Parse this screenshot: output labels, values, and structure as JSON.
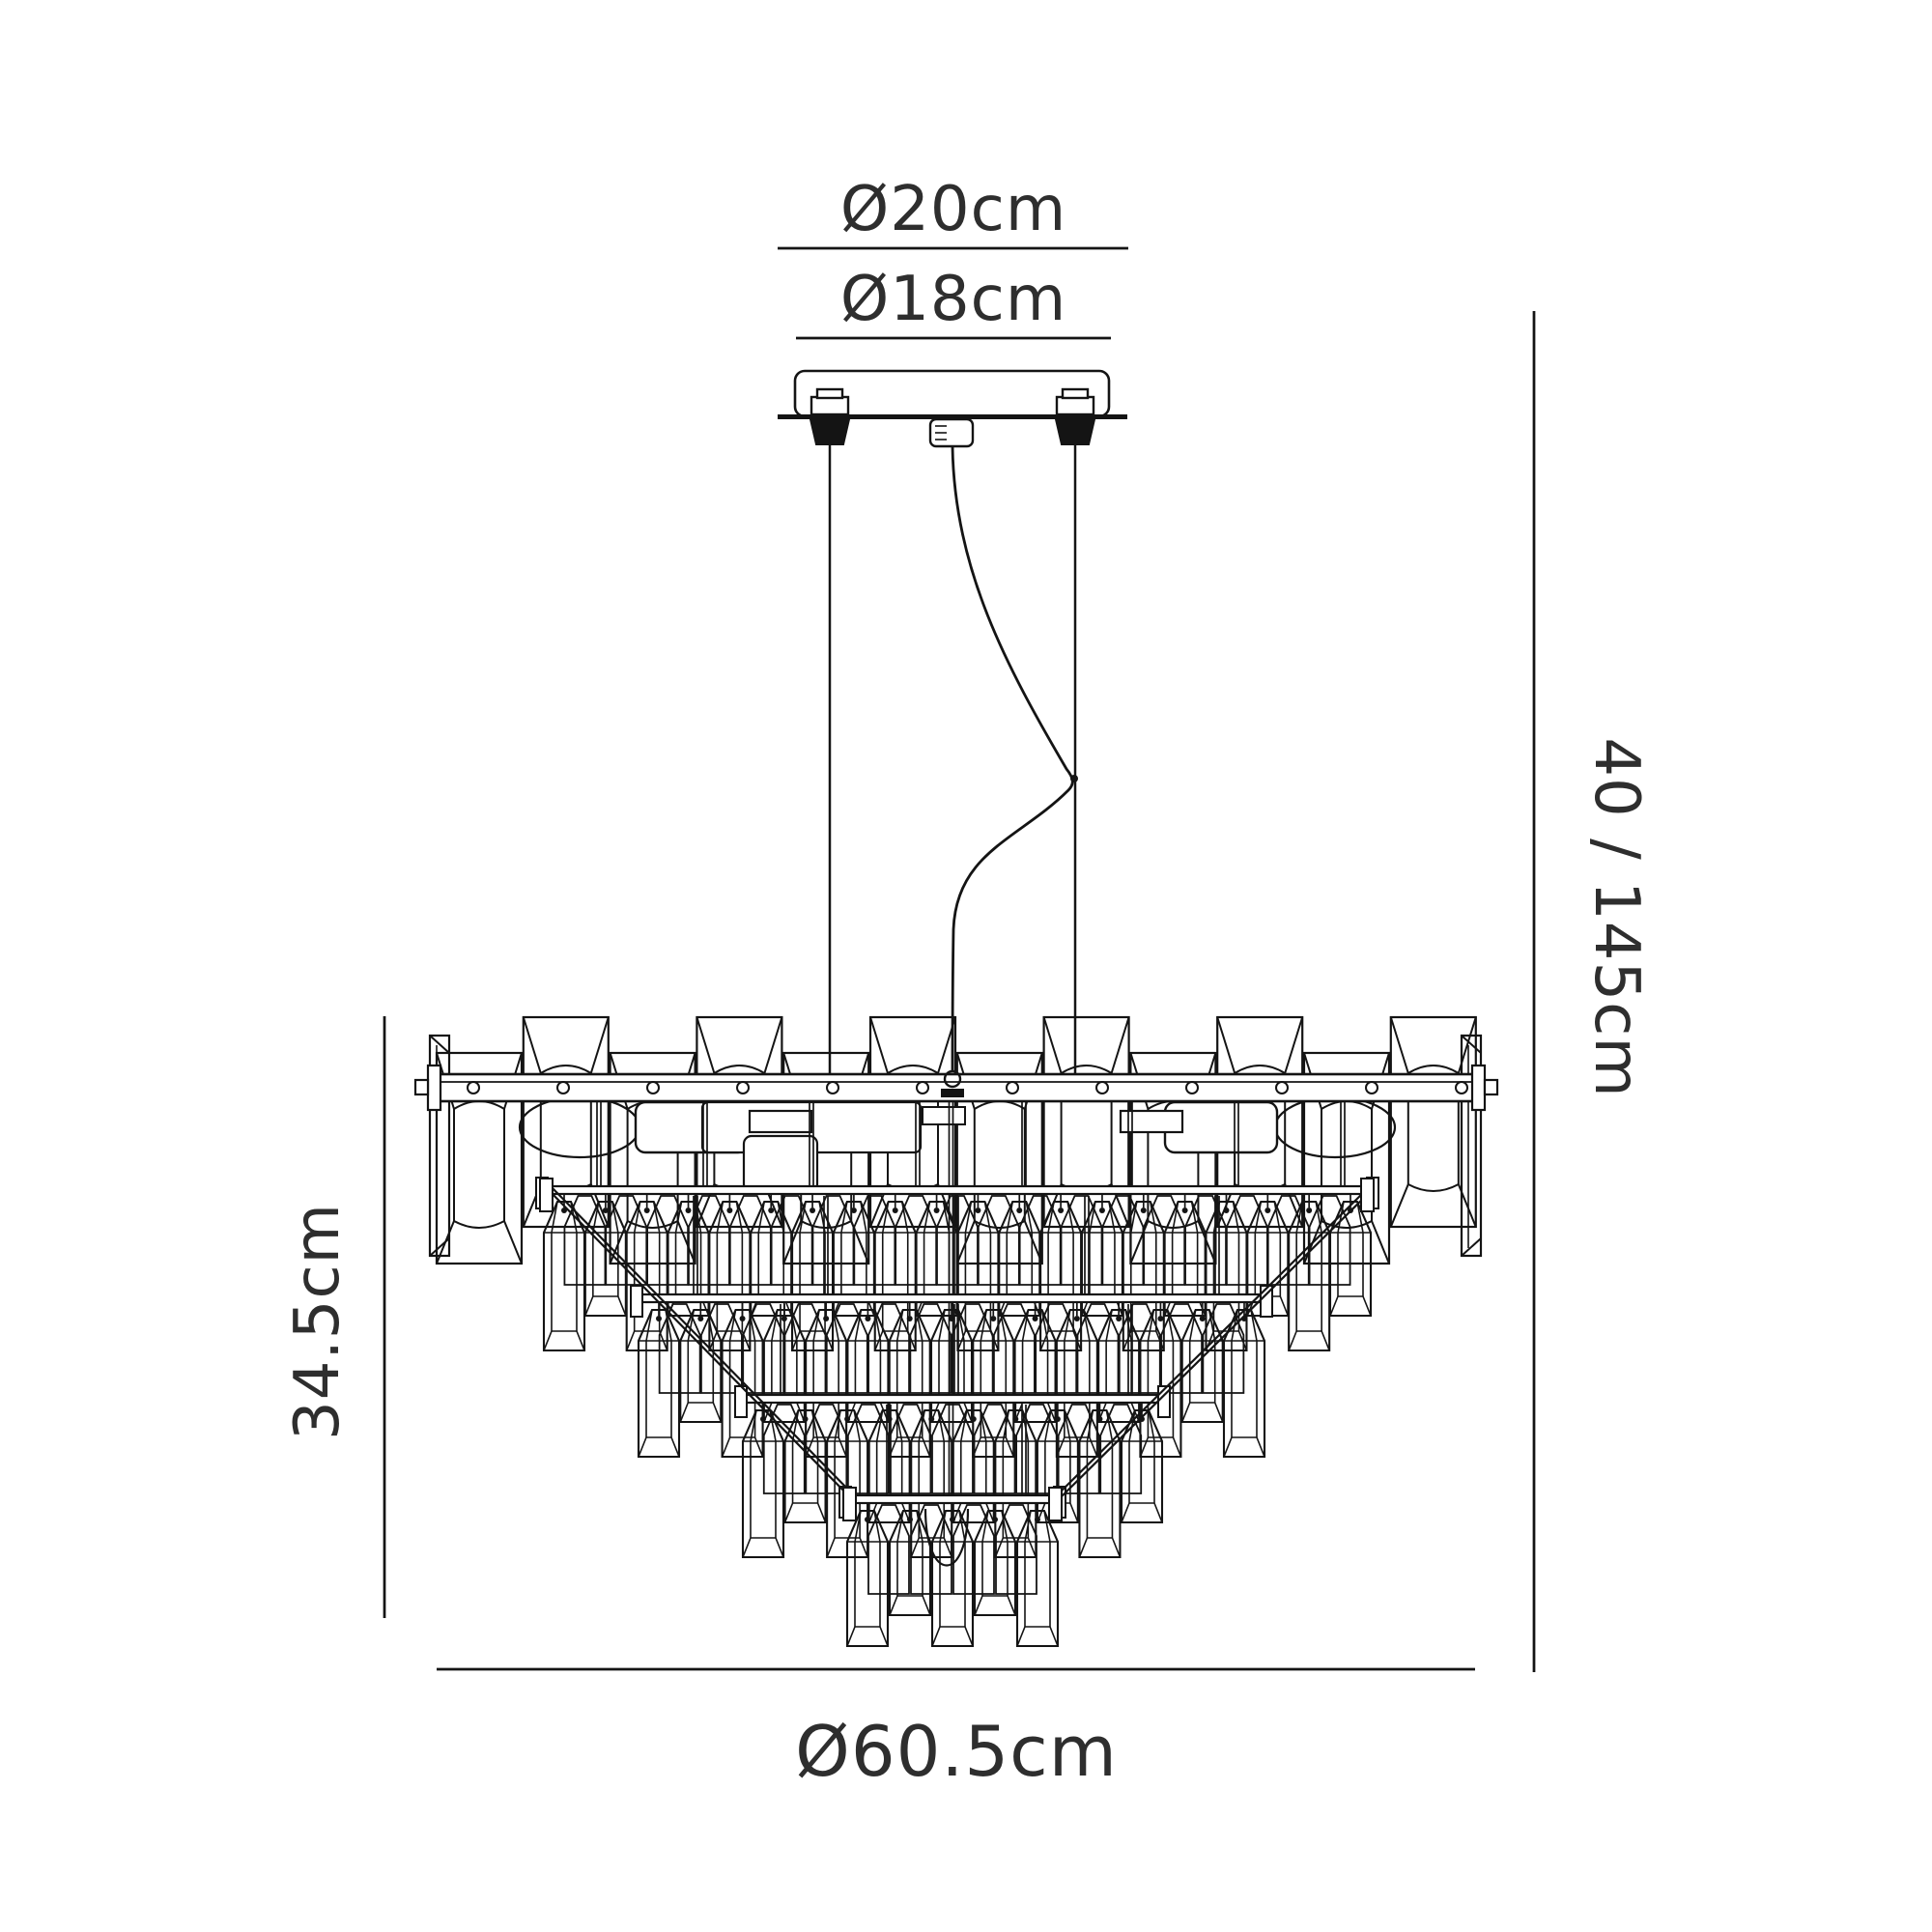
{
  "drawing": {
    "title": "Chandelier dimension diagram",
    "dimensions": {
      "canopy_outer": "Ø20cm",
      "canopy_inner": "Ø18cm",
      "suspension_drop": "40 / 145cm",
      "body_height": "34.5cm",
      "body_diameter": "Ø60.5cm"
    },
    "colors": {
      "line": "#141414",
      "text": "#2e2e2e",
      "background": "#ffffff"
    }
  }
}
